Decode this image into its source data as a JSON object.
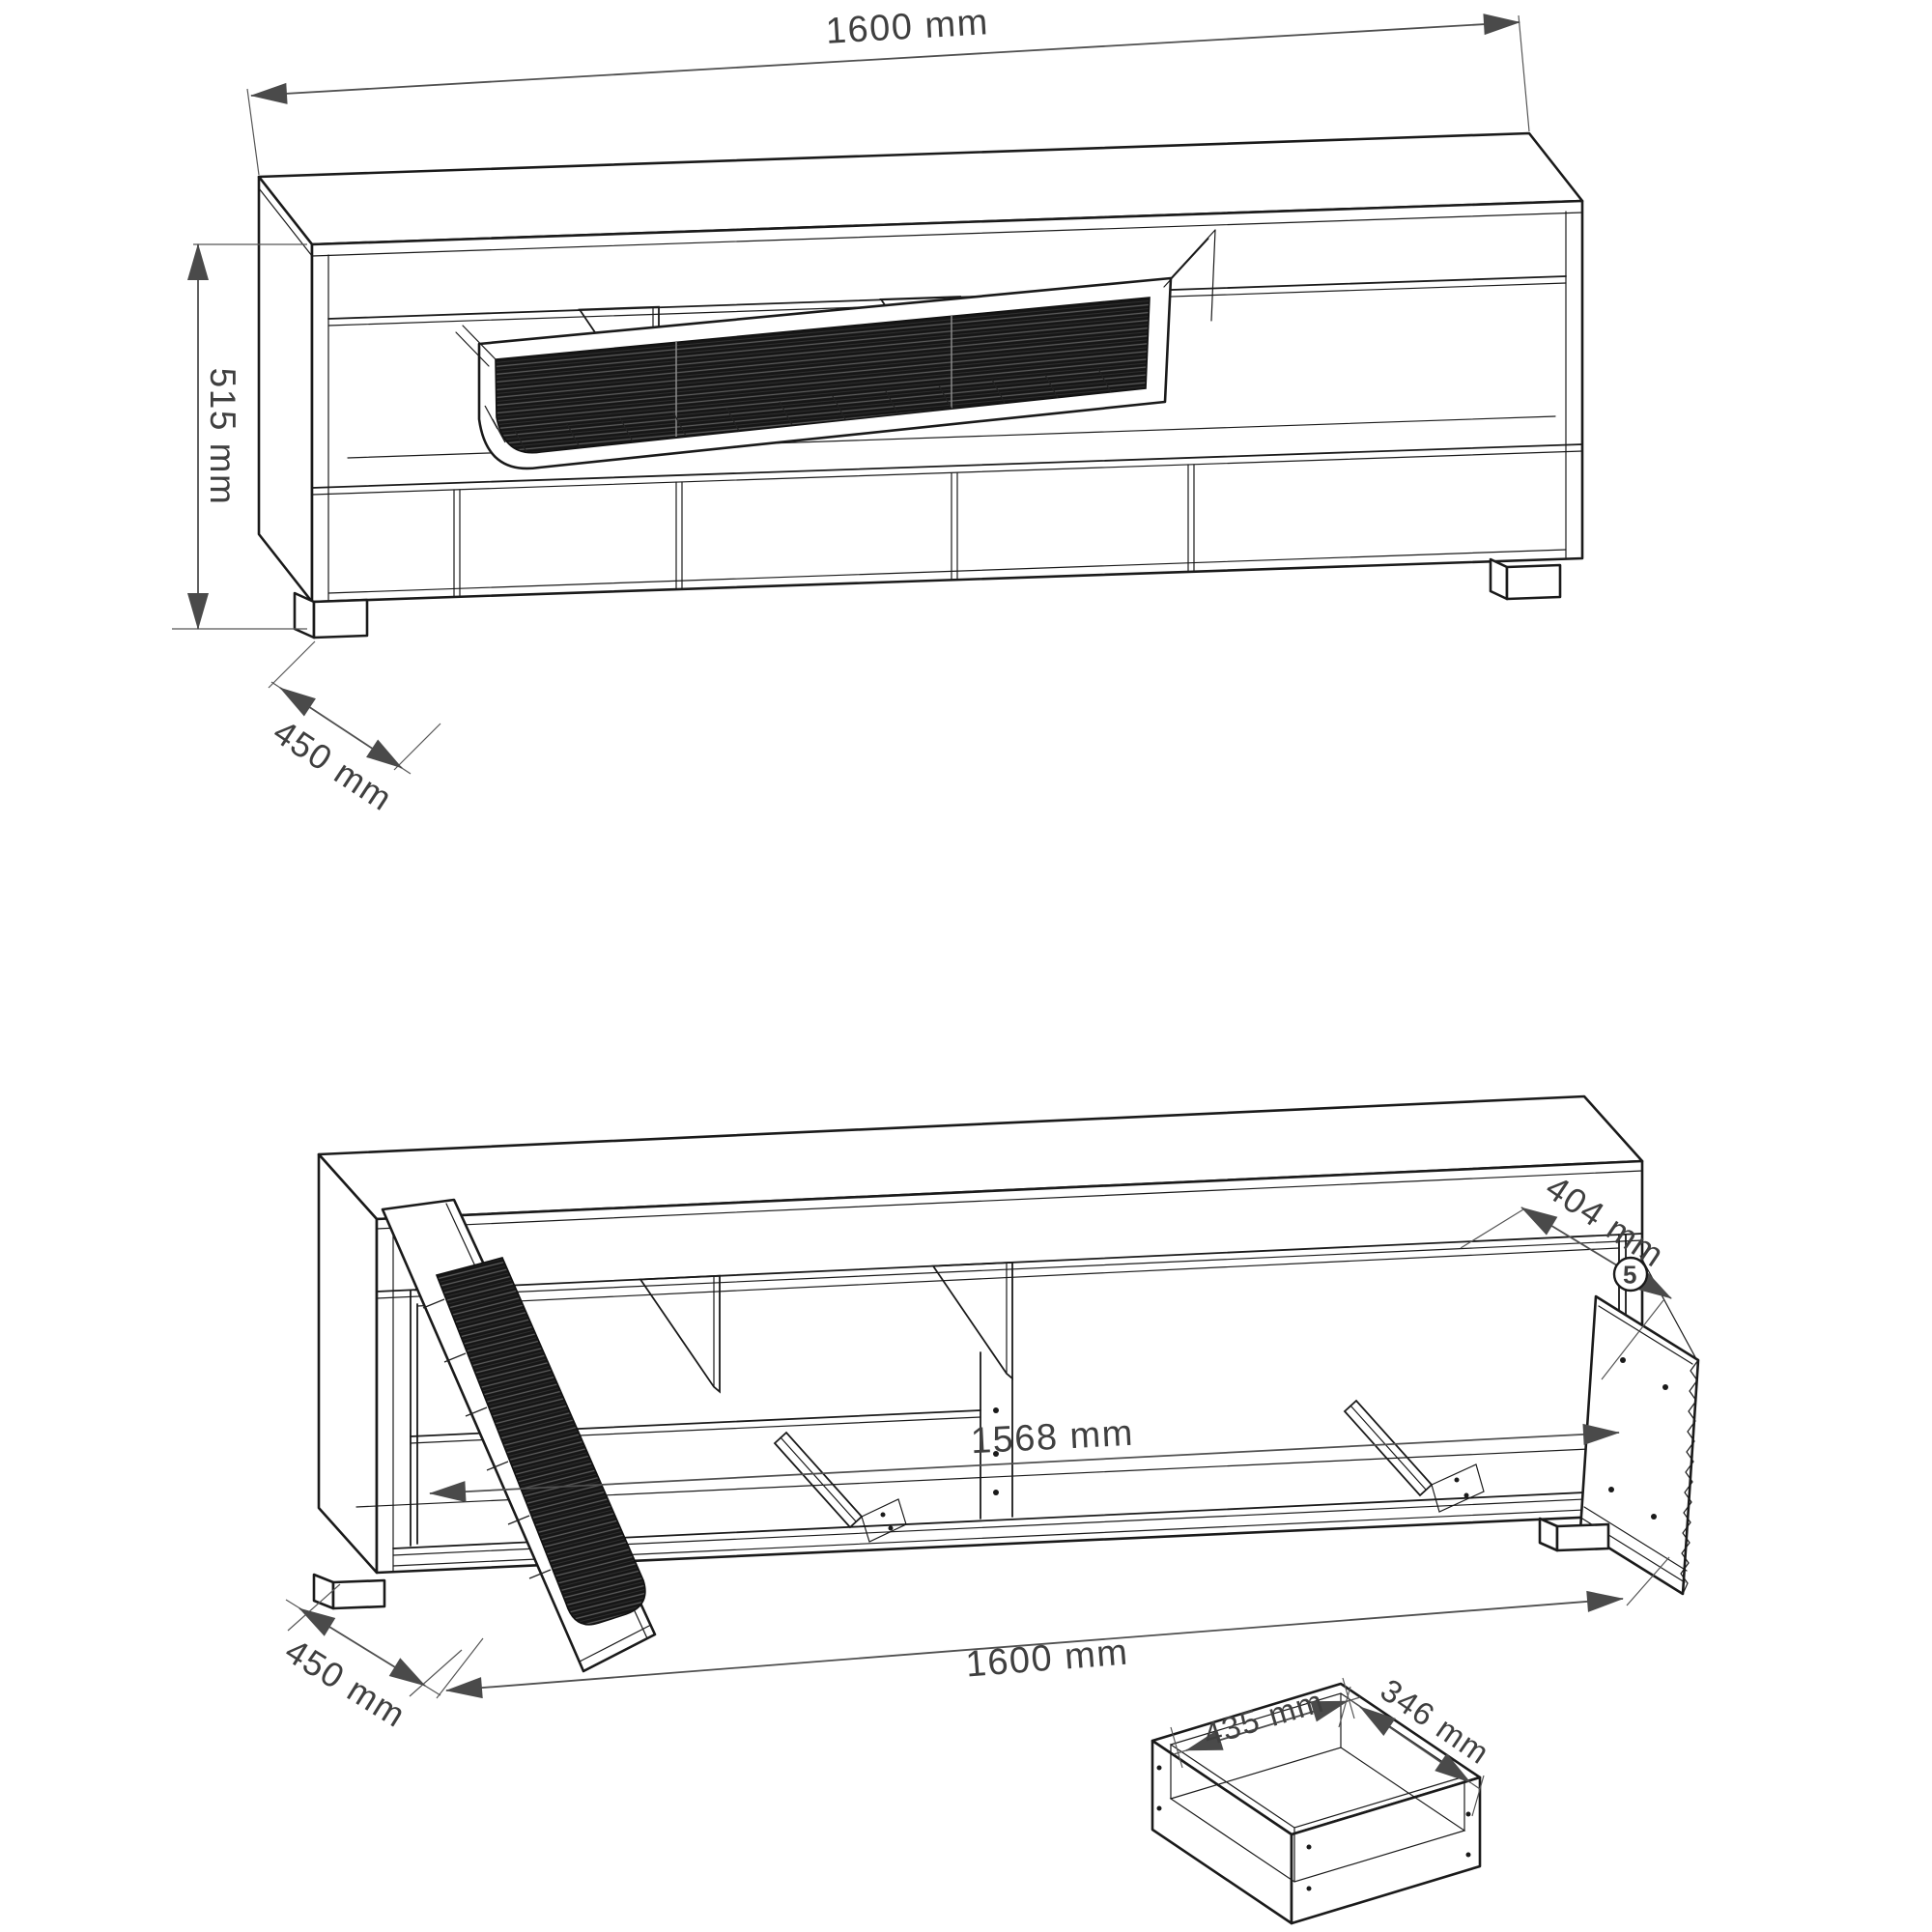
{
  "colors": {
    "outline": "#1a1a1a",
    "dimension_line": "#4f4f4f",
    "dimension_text": "#3f3f3f",
    "louver_fill": "#161616",
    "background": "#ffffff"
  },
  "closed_view": {
    "dims": {
      "width": "1600 mm",
      "height": "515 mm",
      "depth": "450 mm"
    }
  },
  "open_view": {
    "dims": {
      "top_depth": "404 mm",
      "inner_width": "1568 mm",
      "width": "1600 mm",
      "depth": "450 mm"
    },
    "callout_number": "5"
  },
  "drawer_detail": {
    "dims": {
      "inner_width": "435 mm",
      "inner_depth": "346 mm"
    }
  }
}
